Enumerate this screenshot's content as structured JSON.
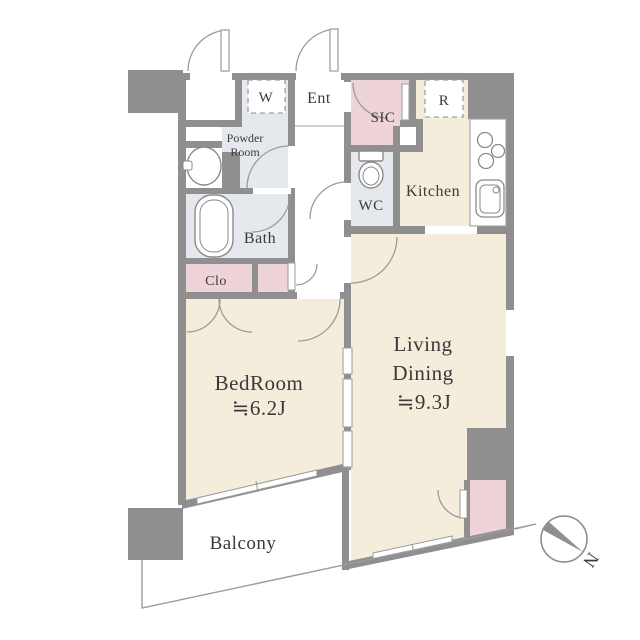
{
  "floorplan": {
    "title": "apartment-floor-plan",
    "rooms": {
      "washer": "W",
      "entrance": "Ent",
      "shoe_closet": "SIC",
      "refrigerator": "R",
      "powder_line1": "Powder",
      "powder_line2": "Room",
      "toilet": "WC",
      "kitchen": "Kitchen",
      "bath": "Bath",
      "closet": "Clo",
      "bedroom_name": "BedRoom",
      "bedroom_size": "≒6.2J",
      "living_line1": "Living",
      "living_line2": "Dining",
      "living_size": "≒9.3J",
      "balcony": "Balcony"
    },
    "compass": {
      "north_label": "N"
    },
    "colors": {
      "wall_gray": "#8f8f8f",
      "floor_beige": "#f4eddc",
      "floor_pink": "#eed3d8",
      "floor_wet_gray": "#e5e8ec",
      "line_gray": "#9b9b9b",
      "text_dark": "#3a3a3a"
    }
  }
}
